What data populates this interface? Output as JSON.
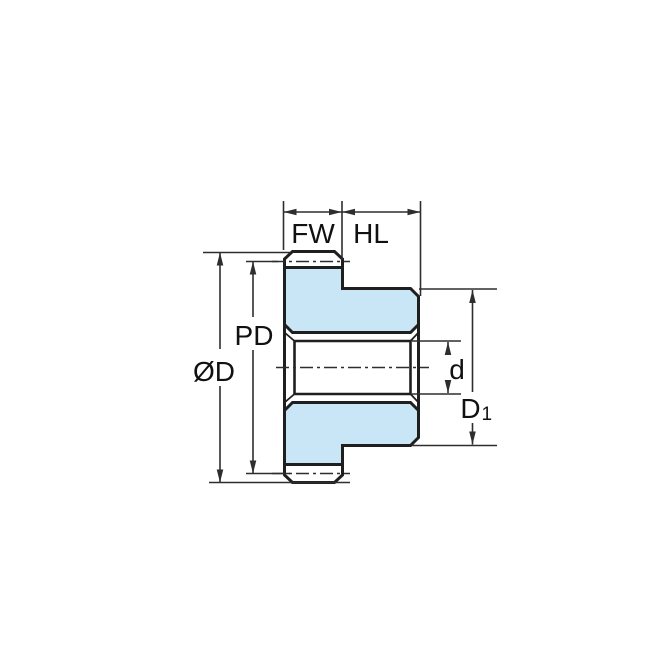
{
  "diagram": {
    "labels": {
      "fw": "FW",
      "hl": "HL",
      "pd": "PD",
      "od": "ØD",
      "d": "d",
      "d1_base": "D",
      "d1_sub": "1"
    },
    "colors": {
      "part_fill": "#c9e6f7",
      "outline": "#1f1f1f",
      "dimension": "#2e2e2e",
      "text": "#111111",
      "background": "#ffffff"
    }
  }
}
